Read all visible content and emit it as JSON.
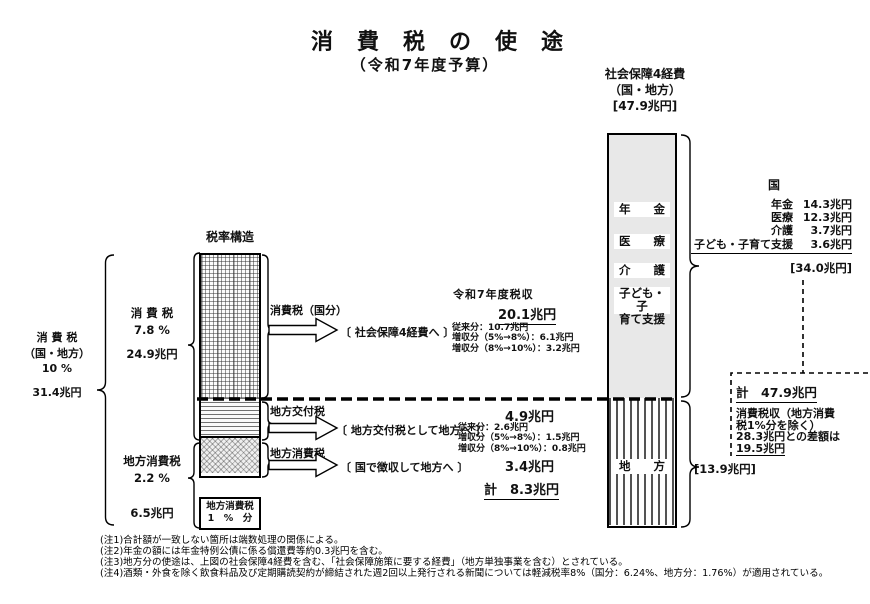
{
  "title": {
    "main": "消費税の使途",
    "sub": "（令和7年度予算）"
  },
  "social_security_header": {
    "line1": "社会保障4経費",
    "line2": "（国・地方）",
    "line3": "[47.9兆円]"
  },
  "tax_structure": {
    "heading": "税率構造",
    "outer": {
      "name": "消 費 税",
      "scope": "（国・地方）",
      "rate": "10 %",
      "amount": "31.4兆円"
    },
    "national": {
      "name": "消 費 税",
      "rate": "7.8 %",
      "amount": "24.9兆円"
    },
    "local": {
      "name": "地方消費税",
      "rate": "2.2 %",
      "amount": "6.5兆円"
    },
    "one_percent_box": {
      "line1": "地方消費税",
      "line2": "1　%　分"
    }
  },
  "flows": {
    "f1": {
      "label": "消費税（国分）",
      "dest": "〔 社会保障4経費へ 〕"
    },
    "f2": {
      "label": "地方交付税",
      "dest": "〔 地方交付税として地方へ 〕"
    },
    "f3": {
      "label": "地方消費税",
      "dest": "〔 国で徴収して地方へ 〕"
    }
  },
  "revenue": {
    "heading": "令和7年度税収",
    "national_total": "20.1兆円",
    "national_items": [
      "従来分：10.7兆円",
      "増収分（5%→8%）：6.1兆円",
      "増収分（8%→10%）：3.2兆円"
    ],
    "kofu_total": "4.9兆円",
    "kofu_items": [
      "従来分：2.6兆円",
      "増収分（5%→8%）：1.5兆円",
      "増収分（8%→10%）：0.8兆円"
    ],
    "local_total": "3.4兆円",
    "local_grand_total": "計　8.3兆円"
  },
  "bar": {
    "nenkin": "年　　金",
    "iryo": "医　　療",
    "kaigo": "介　　護",
    "kodomo1": "子ども・子",
    "kodomo2": "育て支援",
    "chihou": "地　　方",
    "chihou_amount": "[13.9兆円]"
  },
  "kuni_breakdown": {
    "heading": "国",
    "items": [
      {
        "label": "年金",
        "value": "14.3兆円"
      },
      {
        "label": "医療",
        "value": "12.3兆円"
      },
      {
        "label": "介護",
        "value": "3.7兆円"
      },
      {
        "label": "子ども・子育て支援",
        "value": "3.6兆円"
      }
    ],
    "subtotal": "[34.0兆円]"
  },
  "total_box": {
    "total": "計　47.9兆円",
    "line1": "消費税収（地方消費",
    "line2": "税1%分を除く）",
    "line3": "28.3兆円との差額は",
    "line4": "19.5兆円"
  },
  "notes": [
    "(注1)合計額が一致しない箇所は端数処理の関係による。",
    "(注2)年金の額には年金特例公債に係る償還費等約0.3兆円を含む。",
    "(注3)地方分の使途は、上図の社会保障4経費を含む、「社会保障施策に要する経費」（地方単独事業を含む）とされている。",
    "(注4)酒類・外食を除く飲食料品及び定期購読契約が締結された週2回以上発行される新聞については軽減税率8%（国分：6.24%、地方分：1.76%）が適用されている。"
  ]
}
